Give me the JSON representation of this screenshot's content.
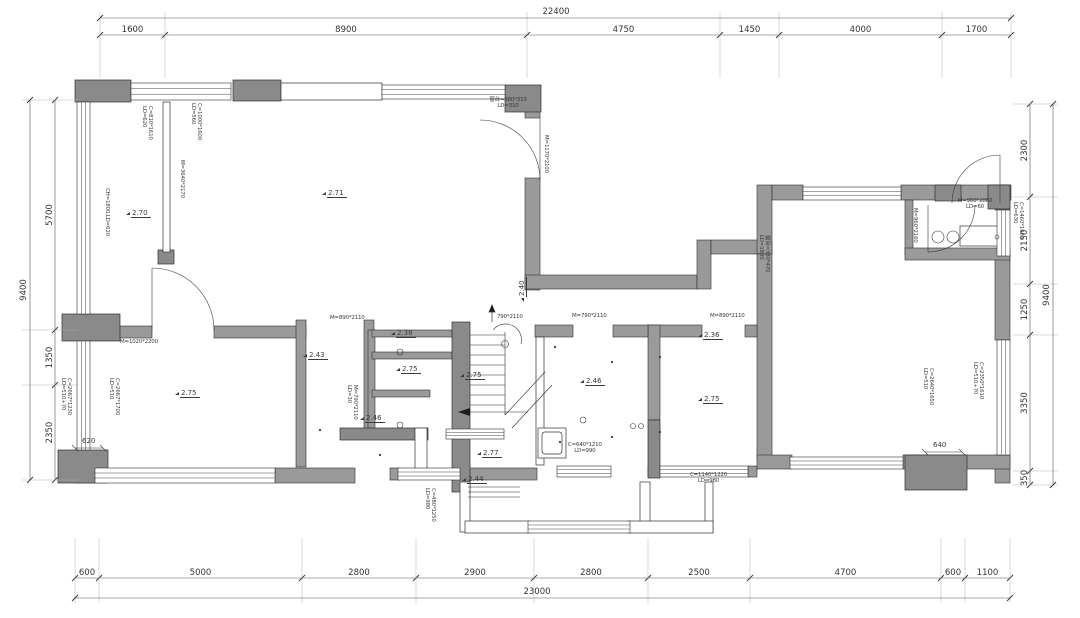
{
  "drawing": {
    "type": "residential floor plan",
    "units": "mm",
    "wall_color": "#9a9a9a",
    "column_color": "#8a8a8a",
    "line_color": "#3a3a3a"
  },
  "dims": {
    "top_total": "22400",
    "top": [
      "1600",
      "8900",
      "4750",
      "1450",
      "4000",
      "1700"
    ],
    "bottom": [
      "600",
      "5000",
      "2800",
      "2900",
      "2800",
      "2500",
      "4700",
      "600",
      "1100"
    ],
    "bottom_total": "23000",
    "left": [
      "5700",
      "1350",
      "2350"
    ],
    "left_total": "9400",
    "right": [
      "2300",
      "2150",
      "1250",
      "3350",
      "350"
    ],
    "right_total": "9400",
    "inline_620": "620",
    "inline_640": "640"
  },
  "elevations": [
    "2.71",
    "2.70",
    "2.75",
    "2.43",
    "2.38",
    "2.75",
    "2.46",
    "2.75",
    "2.77",
    "2.44",
    "2.46",
    "2.36",
    "2.75",
    "2.40"
  ],
  "specs": [
    "C=810*1610\nLD=620",
    "C=1000*1600\nLD=560",
    "M=3640*2170",
    "CH=1800,LD=620",
    "窗台=380*310\nLD=310",
    "M=1170*2100",
    "M=1020*2200",
    "C=2667*1700\nLD=510",
    "C=2667*1230\nLD=510+70",
    "M=890*2110",
    "790*2110",
    "M=790*2110\nLD=30",
    "M=790*2110",
    "M=890*2110",
    "C=640*1210\nLD=990",
    "C=1140*1220\nLD=980",
    "C=480*1250\nLD=980",
    "窗台=330*470\nLD=1800",
    "M=960*2080\nLD=60",
    "M=960*2160",
    "C=1460*1600\nLD=630",
    "C=2640*1650\nLD=510",
    "C=2350*1610\nLD=510+70"
  ]
}
